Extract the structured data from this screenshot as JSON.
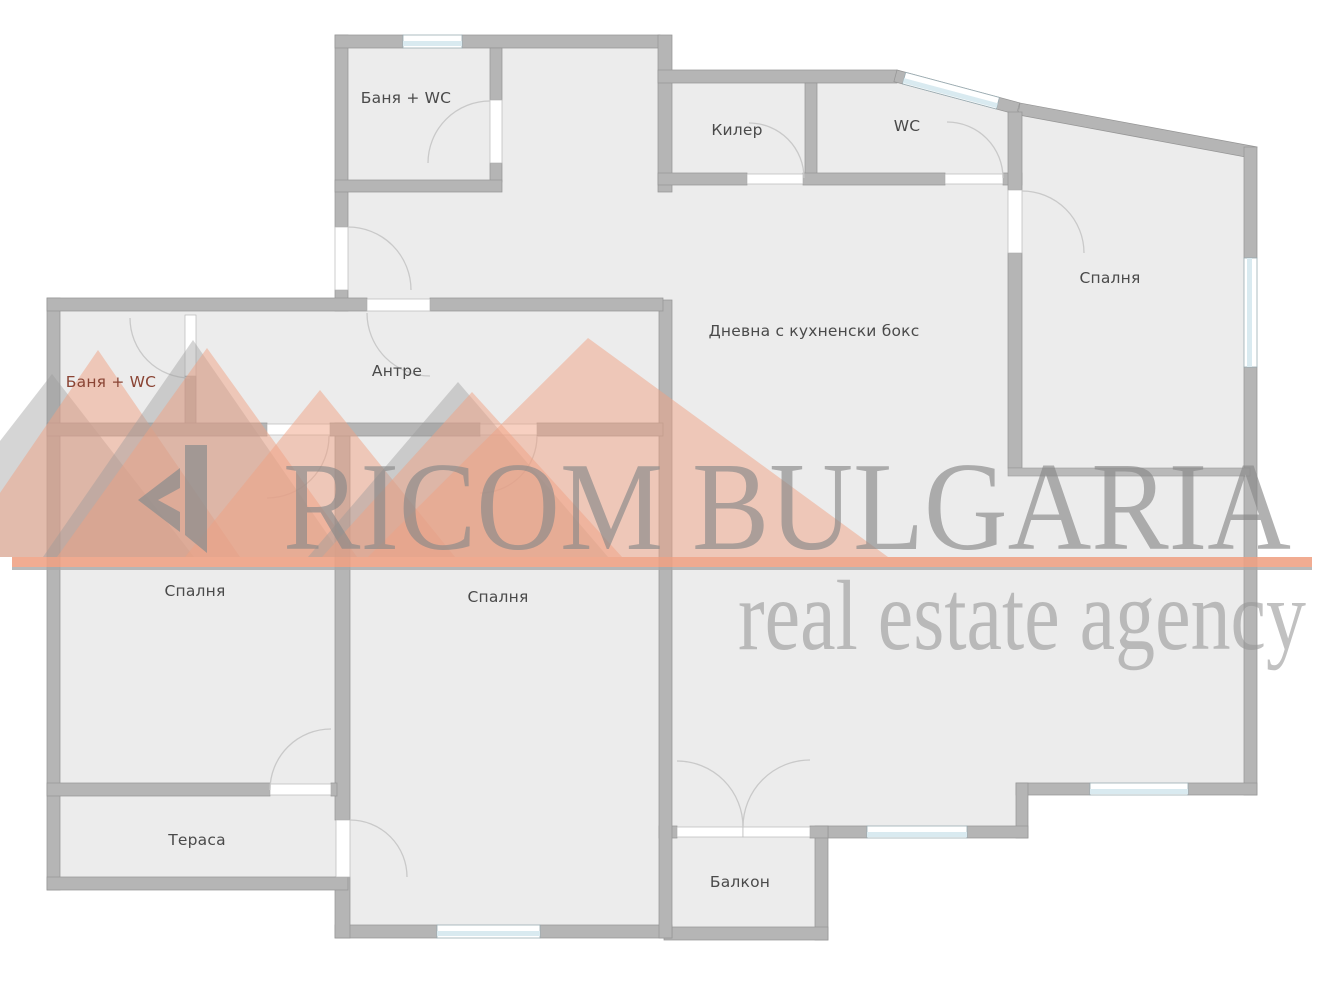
{
  "plan_title": "Apartment floor plan",
  "rooms": [
    {
      "id": "bath-wc-top",
      "label": "Баня + WC"
    },
    {
      "id": "kiler",
      "label": "Килер"
    },
    {
      "id": "wc",
      "label": "WC"
    },
    {
      "id": "bedroom-right",
      "label": "Спалня"
    },
    {
      "id": "living",
      "label": "Дневна с кухненски бокс"
    },
    {
      "id": "antre",
      "label": "Антре"
    },
    {
      "id": "bath-wc-left",
      "label": "Баня + WC"
    },
    {
      "id": "bedroom-left",
      "label": "Спалня"
    },
    {
      "id": "bedroom-middle",
      "label": "Спалня"
    },
    {
      "id": "terrace",
      "label": "Тераса"
    },
    {
      "id": "balcony",
      "label": "Балкон"
    }
  ],
  "watermark": {
    "brand": "RICOM BULGARIA",
    "tagline": "real estate agency",
    "accent_color": "#f0a184",
    "text_color": "#9c9c9c"
  },
  "colors": {
    "background": "#ffffff",
    "floor": "#ececec",
    "wall": "#b5b5b5",
    "window_glass": "#d9eaf0",
    "label_text": "#4a4a4a",
    "label_text_red": "#8a4434"
  }
}
